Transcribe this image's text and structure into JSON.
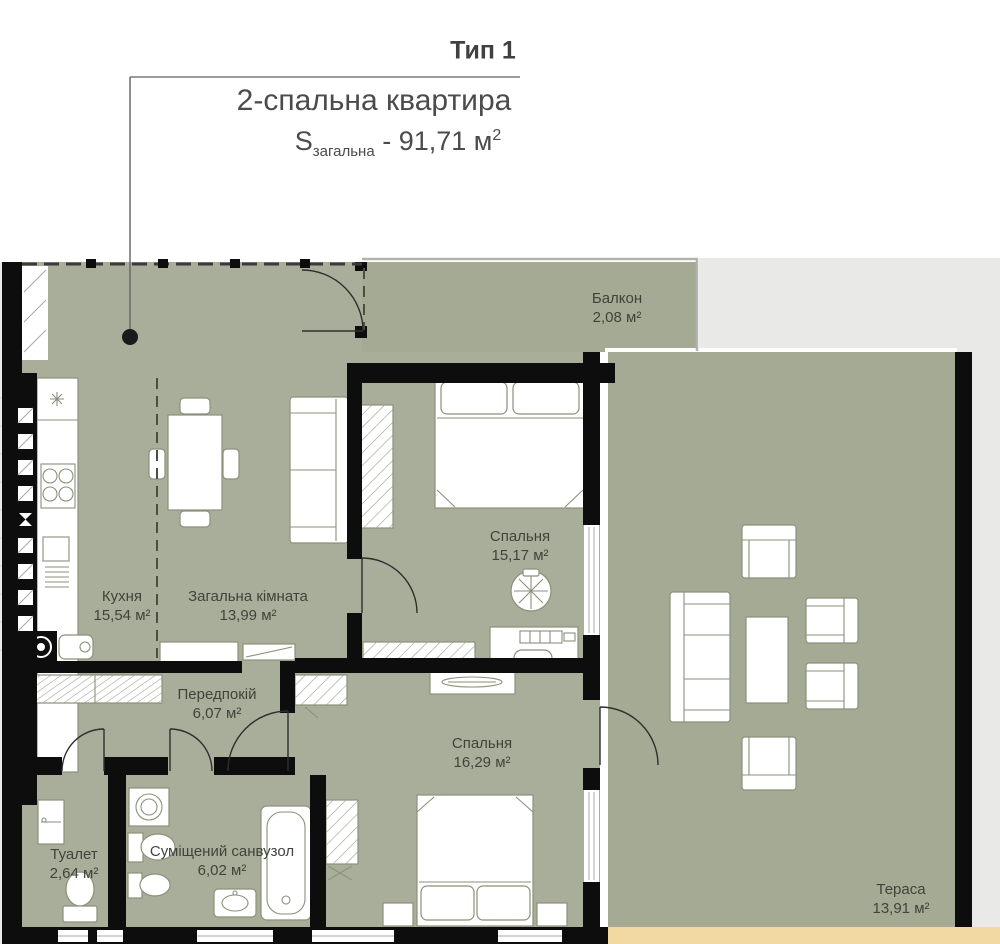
{
  "title": {
    "type_label": "Тип 1",
    "apartment": "2-спальна квартира",
    "s_symbol": "S",
    "s_subscript": "загальна",
    "s_value": " - 91,71 м",
    "s_sup": "2"
  },
  "rooms": {
    "balcony": {
      "name": "Балкон",
      "area": "2,08 м²"
    },
    "bedroom1": {
      "name": "Спальня",
      "area": "15,17 м²"
    },
    "kitchen": {
      "name": "Кухня",
      "area": "15,54 м²"
    },
    "living": {
      "name": "Загальна кімната",
      "area": "13,99 м²"
    },
    "hallway": {
      "name": "Передпокій",
      "area": "6,07 м²"
    },
    "bedroom2": {
      "name": "Спальня",
      "area": "16,29 м²"
    },
    "toilet": {
      "name": "Туалет",
      "area": "2,64 м²"
    },
    "bathroom": {
      "name": "Суміщений санвузол",
      "area": "6,02 м²"
    },
    "terrace": {
      "name": "Тераса",
      "area": "13,91 м²"
    }
  },
  "colors": {
    "floor": "#a9ae9a",
    "outdoor": "#a4aa94",
    "wall": "#0d0d0d",
    "tan": "#f2d9a2",
    "outside": "#e9e9e7",
    "furn": "#8a9179",
    "text": "#3f443a",
    "title": "#404040"
  }
}
